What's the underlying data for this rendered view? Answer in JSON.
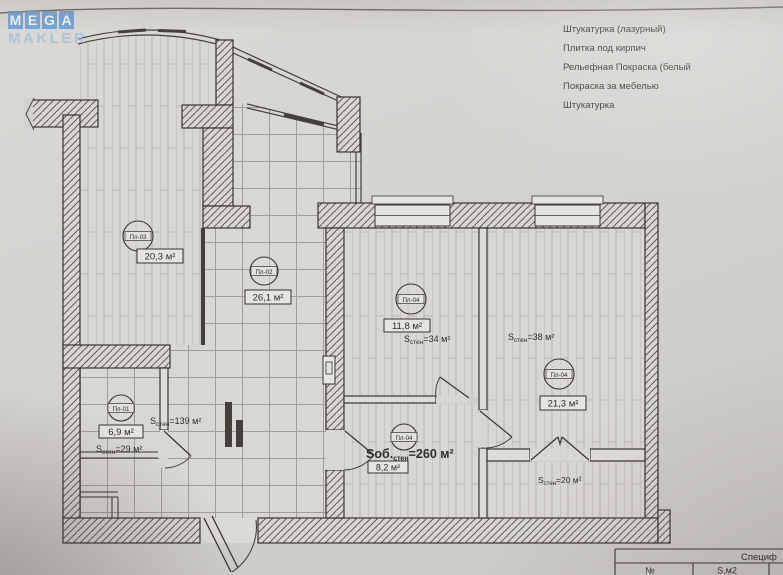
{
  "photo": {
    "watermark": {
      "letters": [
        "M",
        "E",
        "G",
        "A"
      ],
      "word_bottom": "MAKLER",
      "accent_color": "#609ad2"
    },
    "legend_items": [
      "Штукатурка (лазурный)",
      "Плитка под кирпич",
      "Рельефная Покраска (белый",
      "Покраска за мебелью",
      "Штукатурка"
    ]
  },
  "plan": {
    "rooms": {
      "balcony": {
        "code": "Пл-03",
        "area": "20,3 м²"
      },
      "living": {
        "code": "Пл-02",
        "area": "26,1 м²"
      },
      "bedroom1": {
        "code": "Пл-04",
        "area": "11,8 м²",
        "walls_s": "S",
        "walls_sub": "стен",
        "walls_val": "=34 м²"
      },
      "bedroom2": {
        "code": "Пл-04",
        "area": "21,3 м²",
        "walls_s": "S",
        "walls_sub": "стен",
        "walls_val": "=38 м²"
      },
      "bathroom": {
        "code": "Пл-01",
        "area": "6,9 м²",
        "walls_s": "S",
        "walls_sub": "стен",
        "walls_val": "=29 м²"
      },
      "hallway": {
        "code": "Пл-04",
        "area": "8,2 м²",
        "total_s": "Sоб.",
        "total_sub": "стен",
        "total_val": "=260 м²"
      }
    },
    "hall_label": {
      "s": "S",
      "sub": "стен",
      "val": "=139 м²"
    },
    "storage_label": {
      "s": "S",
      "sub": "стен",
      "val": "=20 м²"
    }
  },
  "spec_table": {
    "title": "Специф",
    "col_no": "№",
    "col_area": "S,м2"
  }
}
